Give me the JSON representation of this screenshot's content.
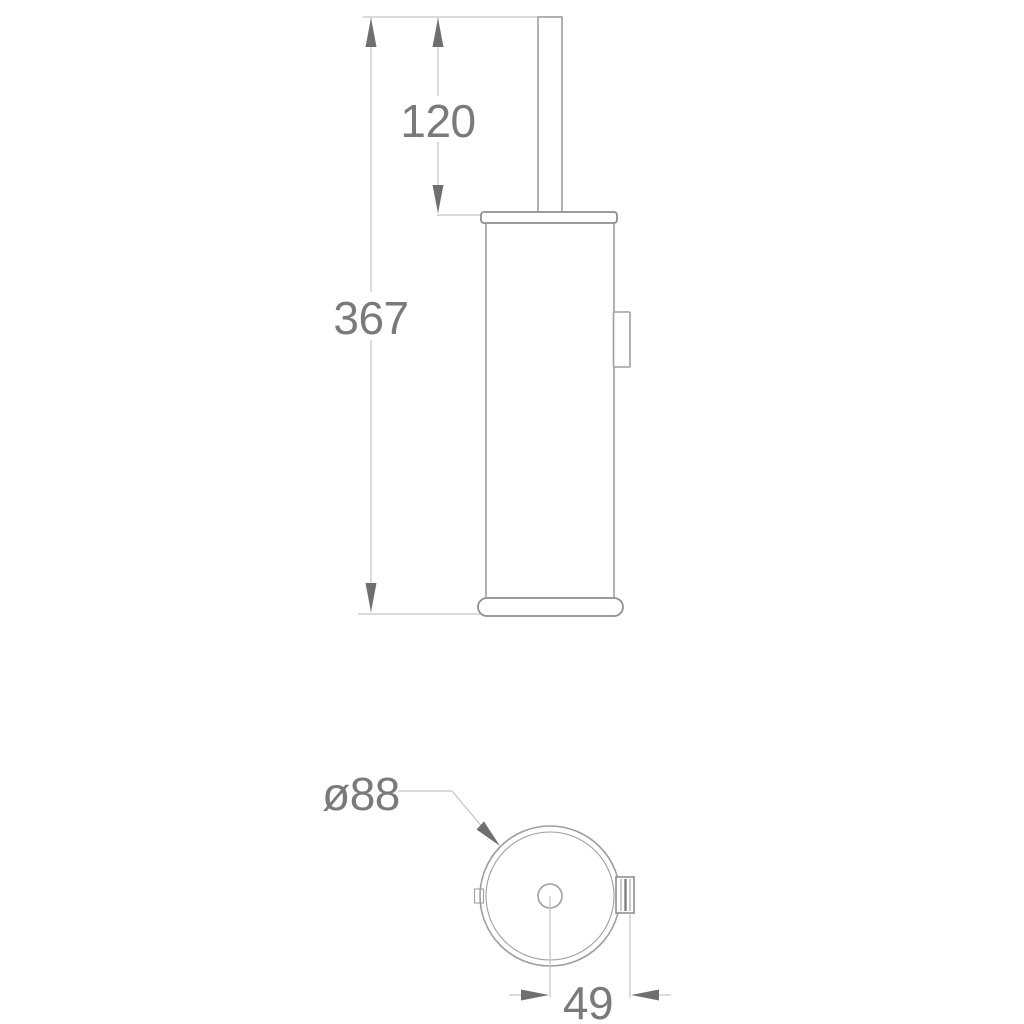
{
  "drawing": {
    "kind": "technical-dimension-drawing",
    "subject": "wall-mounted-toilet-brush-holder",
    "views": {
      "side_view": {
        "dimensions": {
          "rod_height": {
            "label": "120",
            "value": 120
          },
          "total_height": {
            "label": "367",
            "value": 367
          }
        }
      },
      "bottom_view": {
        "dimensions": {
          "diameter": {
            "label": "ø88",
            "value": 88
          },
          "wall_offset": {
            "label": "49",
            "value": 49
          }
        }
      }
    },
    "colors": {
      "background": "#ffffff",
      "object_line": "#9e9e9e",
      "object_line_dark": "#8f8f8f",
      "dim_line": "#c3c3c3",
      "arrow": "#6f6f6f",
      "text": "#7a7a7a"
    }
  }
}
